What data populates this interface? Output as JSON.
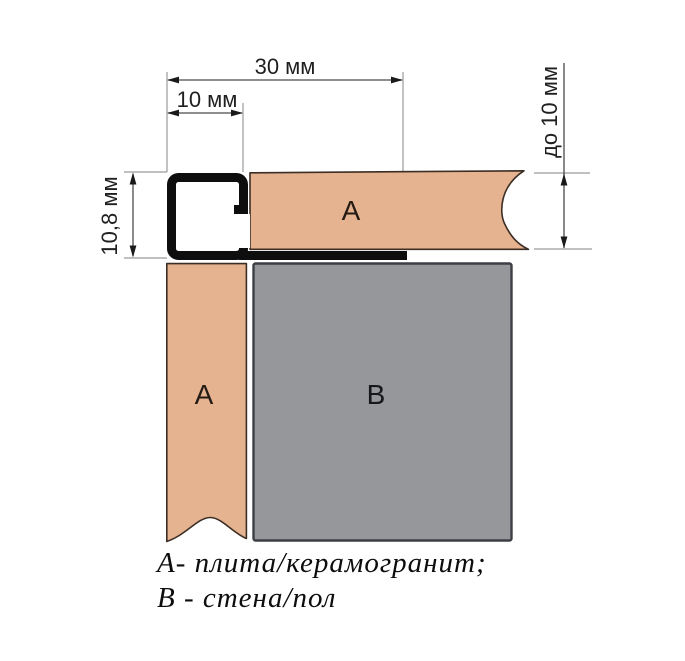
{
  "diagram": {
    "dimensions": {
      "top_outer": "30 мм",
      "top_inner": "10 мм",
      "left": "10,8 мм",
      "right": "до 10 мм"
    },
    "zones": {
      "tile_top": "А",
      "tile_side": "А",
      "base": "В"
    },
    "legend": {
      "line1": "А- плита/керамогранит;",
      "line2": "В - стена/пол"
    },
    "colors": {
      "tile_fill": "#e6b391",
      "base_fill": "#96979a",
      "profile_stroke": "#0e0e0e",
      "tile_outline": "#3d2e24",
      "base_outline": "#3c3f45",
      "dimension_line": "#4a4a4a",
      "extension_line": "#9b9b9b"
    }
  }
}
